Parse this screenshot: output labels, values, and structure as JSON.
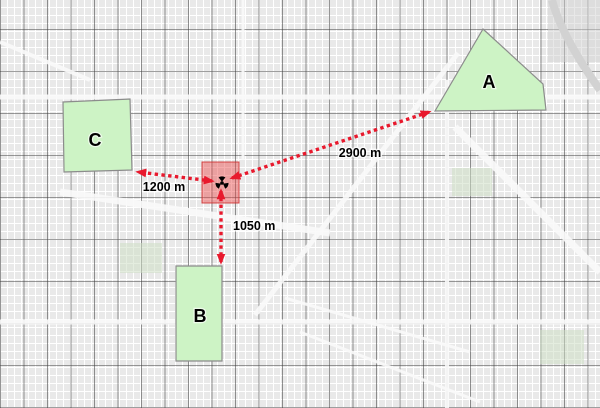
{
  "map": {
    "accent_red": "#e8192d",
    "incident_fill": "rgba(235,70,70,0.45)",
    "incident_stroke": "rgba(205,45,45,0.85)",
    "zone_fill": "#cdf3c5",
    "zone_stroke": "#8c8c8c"
  },
  "zones": [
    {
      "id": "A",
      "label": "A",
      "points": "435,111 483,29 543,84 546,110",
      "label_x": 489,
      "label_y": 88
    },
    {
      "id": "B",
      "label": "B",
      "points": "176,266 222,266 222,361 176,361",
      "label_x": 200,
      "label_y": 322
    },
    {
      "id": "C",
      "label": "C",
      "points": "63,102 130,99 132,170 64,172",
      "label_x": 95,
      "label_y": 146
    }
  ],
  "incident": {
    "icon": "hazard-marker-icon",
    "area": {
      "x": 202,
      "y": 162,
      "w": 37,
      "h": 41
    },
    "point_x": 222,
    "point_y": 183
  },
  "measurements": [
    {
      "label": "2900 m",
      "x1": 232,
      "y1": 178,
      "x2": 429,
      "y2": 112,
      "label_x": 360,
      "label_y": 157,
      "anchor": "middle"
    },
    {
      "label": "1200 m",
      "x1": 212,
      "y1": 181,
      "x2": 138,
      "y2": 172,
      "label_x": 164,
      "label_y": 191,
      "anchor": "middle"
    },
    {
      "label": "1050 m",
      "x1": 221,
      "y1": 191,
      "x2": 221,
      "y2": 262,
      "label_x": 233,
      "label_y": 230,
      "anchor": "start"
    }
  ]
}
